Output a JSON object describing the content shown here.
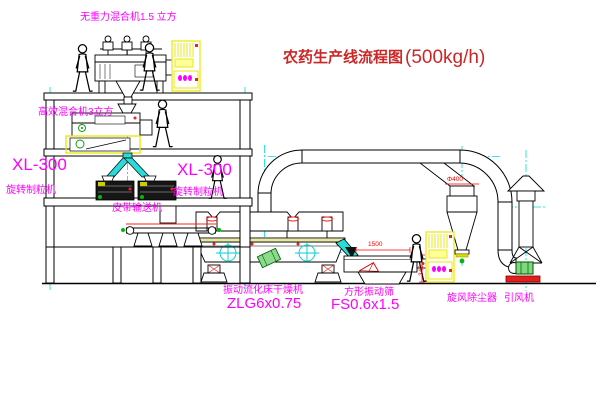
{
  "title": {
    "text": "农药生产线流程图",
    "capacity": "(500kg/h)"
  },
  "equipment_labels": {
    "top_mixer": "无重力混合机1.5 立方",
    "mid_mixer": "高效混合机3立方",
    "granulator_left": {
      "model": "XL-300",
      "name": "旋转制粒机"
    },
    "granulator_right": {
      "model": "XL-300",
      "name": "旋转制粒机"
    },
    "belt_conveyor": "皮带输送机",
    "dryer": {
      "name": "振动流化床干燥机",
      "model": "ZLG6x0.75"
    },
    "screen": {
      "name": "方形振动筛",
      "model": "FS0.6x1.5"
    },
    "cyclone": "旋风除尘器",
    "fan": "引风机"
  },
  "dimensions": {
    "screen_length": "1500",
    "cyclone_diameter": "Φ400",
    "screen_height": "340"
  },
  "colors": {
    "label": "#ff00ff",
    "title": "#cc2626",
    "dimension": "#ff0000",
    "cabinet": "#e8e800",
    "chute": "#2adbdb",
    "centerline": "#00dddd",
    "motor_green": "#00bb00",
    "alert_red": "#ee2222"
  }
}
